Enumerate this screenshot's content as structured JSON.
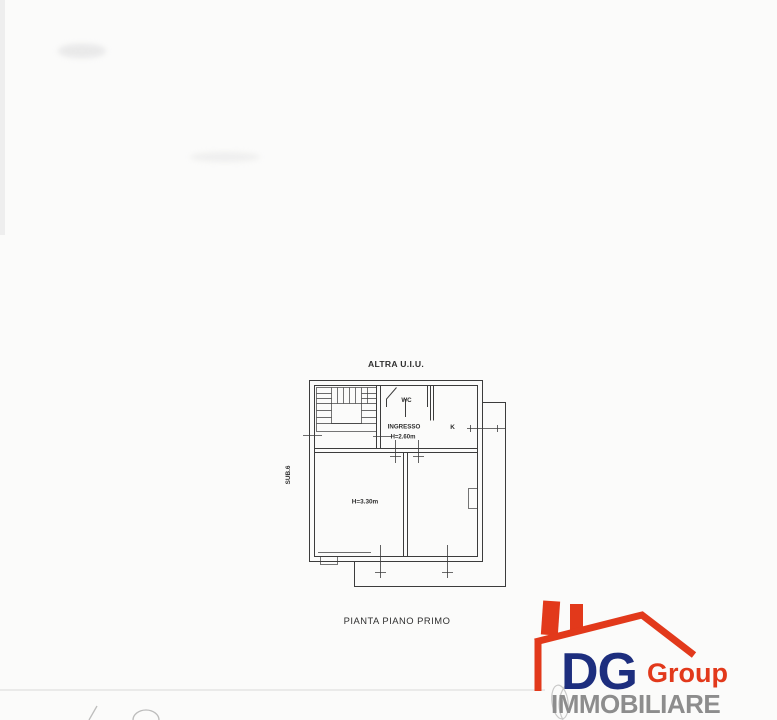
{
  "plan": {
    "title": "ALTRA U.I.U.",
    "sub_label": "SUB.6",
    "caption": "PIANTA PIANO PRIMO",
    "labels": {
      "wc": "WC",
      "ingresso": "INGRESSO",
      "ingresso_height": "H=2.60m",
      "kitchen": "K",
      "room_height": "H=3.30m"
    },
    "colors": {
      "line": "#3c3c3c",
      "text": "#2f2f2f"
    }
  },
  "logo": {
    "name": "DG",
    "suffix": "Group",
    "tagline": "IMMOBILIARE",
    "colors": {
      "red": "#e2391b",
      "navy": "#1d2e7e",
      "gray": "#8d8d8d"
    }
  }
}
